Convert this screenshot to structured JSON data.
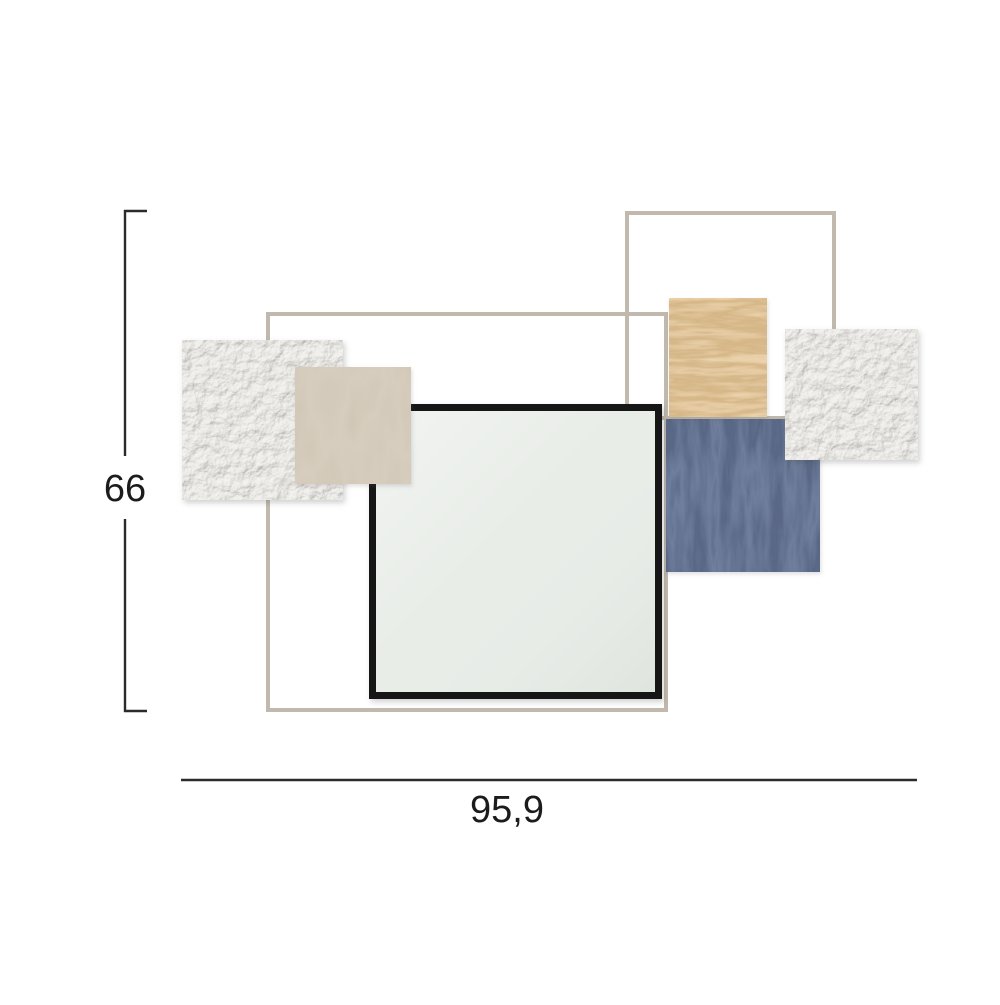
{
  "annotations": {
    "height_label": "66",
    "width_label": "95,9"
  },
  "style": {
    "dimension_line_color": "#2b2b2b",
    "label_color": "#1c1c1c",
    "background": "#ffffff"
  },
  "artwork": {
    "colors": {
      "metal_frame": "#c1b9ae",
      "plaster": "#e6e5e1",
      "beige_panel": "#b4a68f",
      "wood_panel": "#c59a5c",
      "navy_panel": "#2d3b58",
      "mirror_frame": "#161616",
      "mirror_glass": "#e9ede8"
    }
  }
}
